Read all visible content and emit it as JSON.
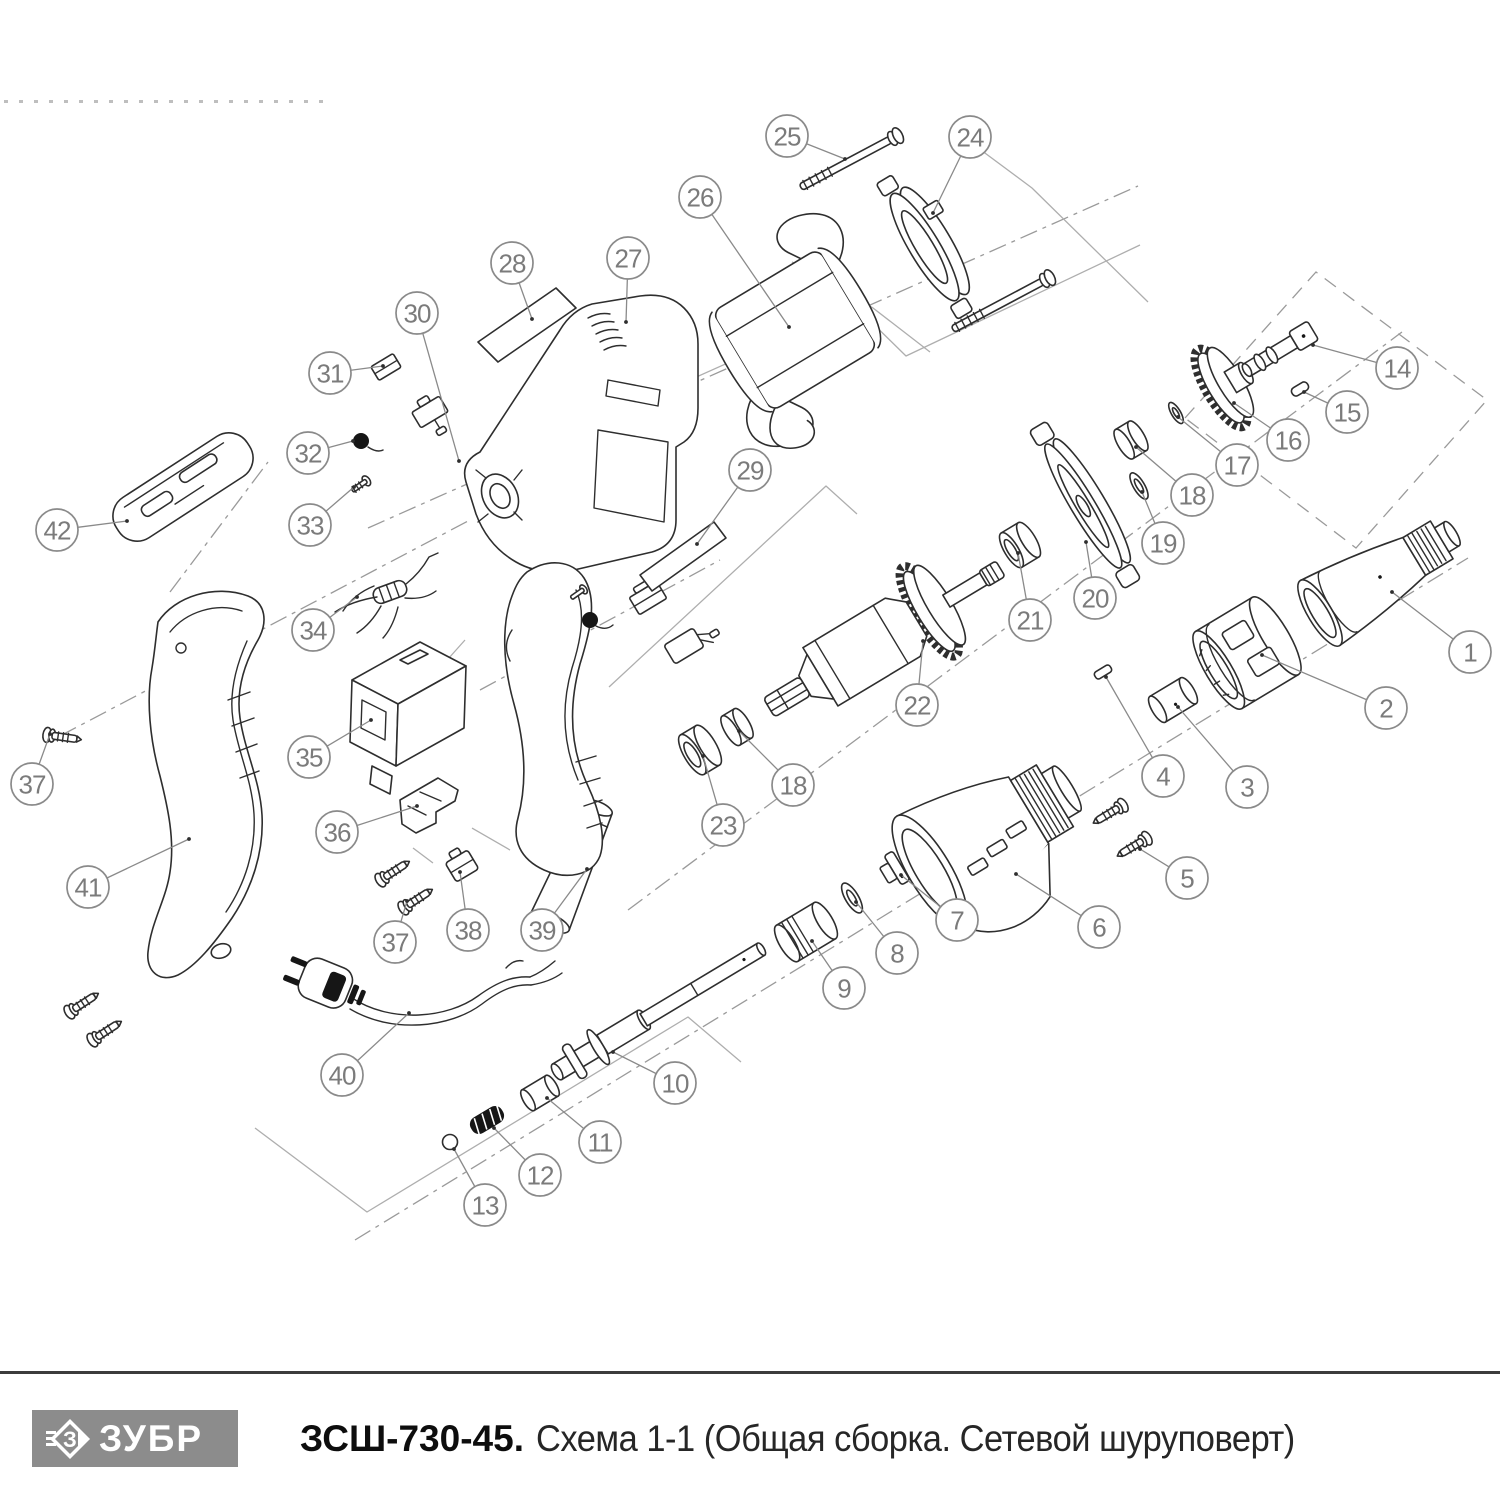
{
  "footer": {
    "brand": "ЗУБР",
    "model": "ЗСШ-730-45.",
    "schema_title": "Схема 1-1 (Общая сборка. Сетевой шуруповерт)"
  },
  "diagram": {
    "description": "Exploded-view assembly drawing of a corded screwdriver",
    "callouts": [
      "1",
      "2",
      "3",
      "4",
      "5",
      "6",
      "7",
      "8",
      "9",
      "10",
      "11",
      "12",
      "13",
      "14",
      "15",
      "16",
      "17",
      "18",
      "19",
      "20",
      "21",
      "22",
      "23",
      "24",
      "25",
      "26",
      "27",
      "28",
      "29",
      "30",
      "31",
      "32",
      "33",
      "34",
      "35",
      "36",
      "37",
      "38",
      "39",
      "40",
      "41",
      "42",
      "18",
      "37"
    ]
  },
  "colors": {
    "drawing_line": "#2e2e2e",
    "construction_line": "#9a9a9a",
    "callout_stroke": "#8a8a8a",
    "logo_background": "#8c8c8c",
    "footer_rule": "#3c3c3c"
  }
}
